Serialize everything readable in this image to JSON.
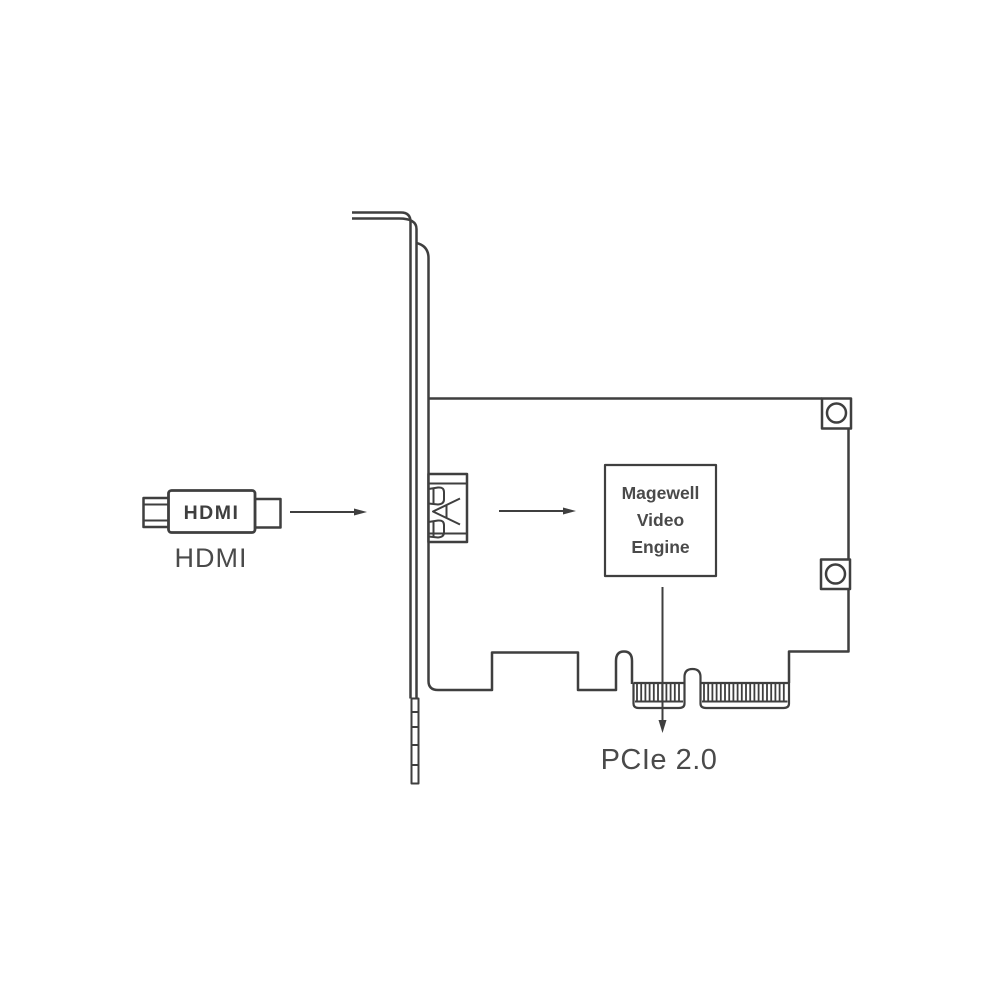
{
  "diagram": {
    "hdmi_plug": {
      "logo": "HDMI",
      "label": "HDMI"
    },
    "video_engine_box": {
      "lines": [
        "Magewell",
        "Video",
        "Engine"
      ]
    },
    "pcie": {
      "label": "PCIe 2.0"
    },
    "icons": {
      "arrow_right": "→",
      "arrow_down": "↓"
    },
    "colors": {
      "stroke": "#3f3f3f",
      "text": "#4a4a4a",
      "background": "#ffffff"
    }
  }
}
